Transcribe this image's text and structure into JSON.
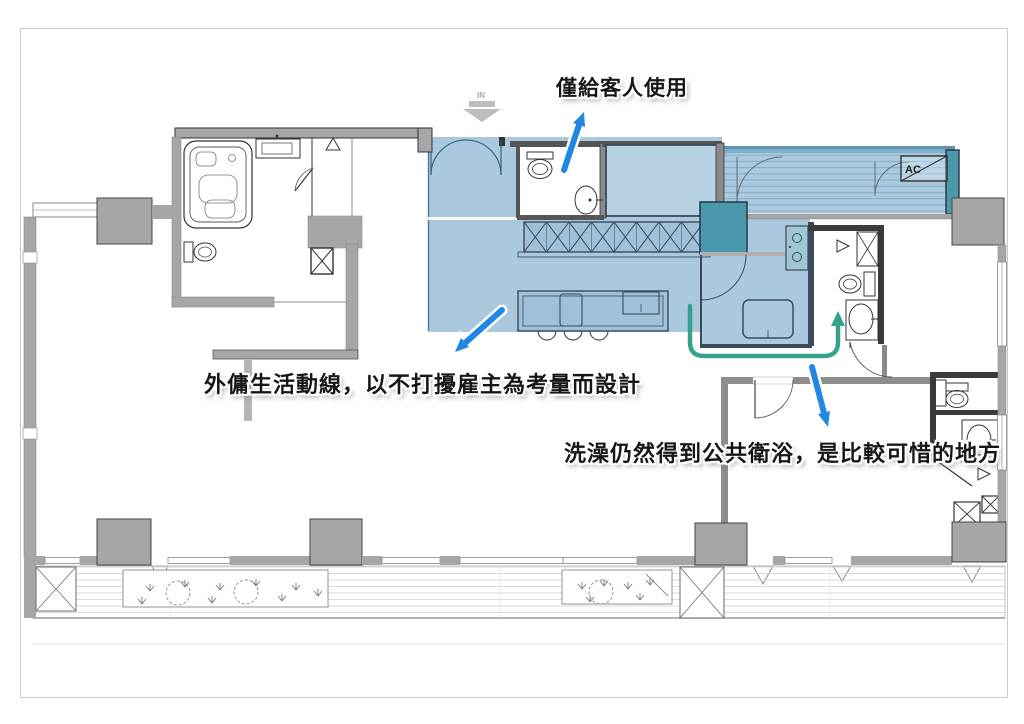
{
  "annotations": {
    "guest_only": "僅給客人使用",
    "maid_flow": "外傭生活動線，以不打擾雇主為考量而設計",
    "public_bath": "洗澡仍然得到公共衛浴，是比較可惜的地方"
  },
  "plan_labels": {
    "entrance": "IN",
    "ac_unit": "AC"
  },
  "colors": {
    "highlight_blue": "#aac8de",
    "highlight_teal_dark": "#4b97ac",
    "balcony_stripe": "#86b0ca",
    "circulation_path": "#35a28f",
    "annotation_arrow": "#2286e3",
    "wall_gray": "#a6a6a6",
    "plan_line_dark": "#3d4a5a"
  }
}
